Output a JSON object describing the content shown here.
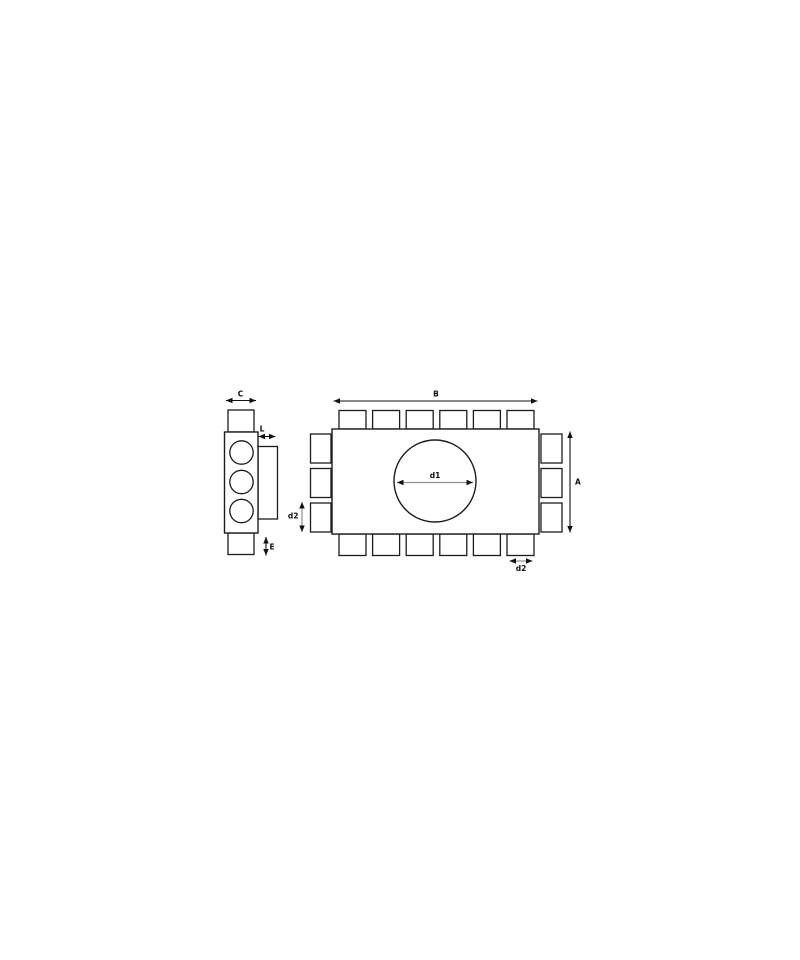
{
  "diagram": {
    "labels": {
      "duct_width": "C",
      "connector_depth": "L",
      "stub_height": "E",
      "box_length": "B",
      "box_height": "A",
      "main_diameter": "d1",
      "side_outlet_diameter": "d2",
      "bottom_outlet_diameter": "d2"
    },
    "colors": {
      "background": "#ffffff",
      "line": "#1c1c1c",
      "dimension": "#111111",
      "diameter_shaft": "#8f8f8f"
    },
    "structure": {
      "front_view": {
        "top_outlet_count": 6,
        "bottom_outlet_count": 6,
        "left_outlet_count": 3,
        "right_outlet_count": 3,
        "center_circle_count": 1
      },
      "side_view": {
        "port_count": 3,
        "top_stub_count": 1,
        "bottom_stub_count": 1,
        "flange_count": 1
      }
    }
  }
}
